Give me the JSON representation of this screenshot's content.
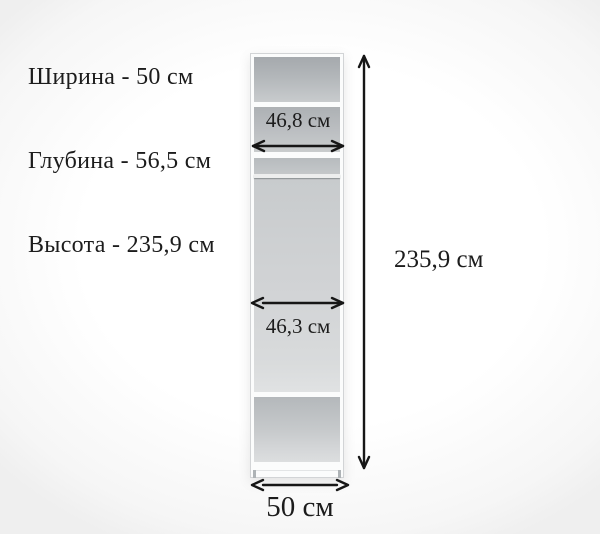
{
  "specs": {
    "line1": "Ширина - 50 см",
    "line2": "Глубина - 56,5 см",
    "line3": "Высота - 235,9 см"
  },
  "diagram": {
    "labels": {
      "upper_shelf_width": "46,8 см",
      "hanging_section_width": "46,3 см",
      "overall_height": "235,9 см",
      "overall_width": "50 см"
    }
  },
  "colors": {
    "text": "#1c1c1c",
    "arrow": "#161616",
    "cabinet_frame": "#fbfcfc",
    "interior_dark": "#a5a9ad",
    "interior_light": "#e0e2e3"
  }
}
